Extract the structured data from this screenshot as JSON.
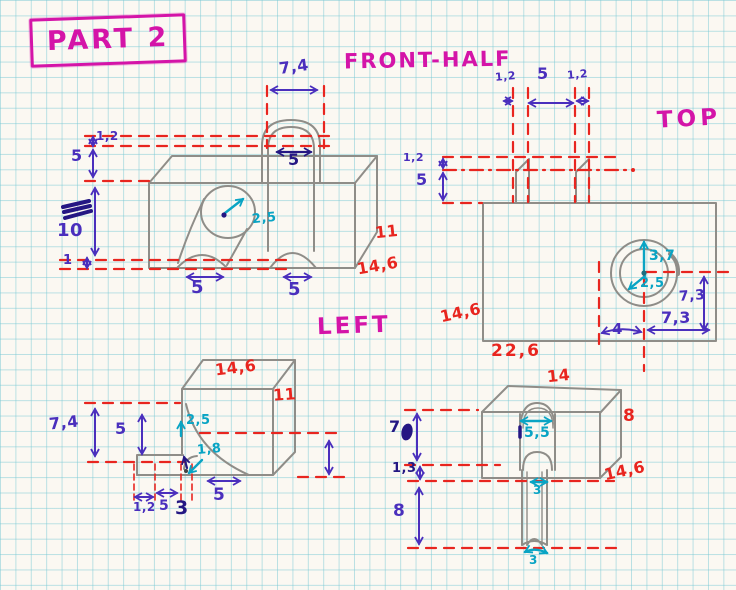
{
  "title": {
    "part_label": "PART 2"
  },
  "colors": {
    "magenta": "#d414a8",
    "purple": "#4a2fbd",
    "teal": "#09a4c4",
    "red": "#e8251f",
    "navy": "#241783",
    "pencil": "#8f8d88"
  },
  "views": {
    "front": {
      "label": "FRONT-HALF",
      "dims": {
        "tab_outer_width": "7,4",
        "slot_width": "5",
        "top_lip": "1,2",
        "upper_height": "5",
        "mid_height": "10",
        "base_lip": "1",
        "bore_radius": "2,5",
        "left_arch_width": "5",
        "right_arch_width": "5",
        "side_depth": "11",
        "overall_width": "14,6"
      }
    },
    "top": {
      "label": "TOP",
      "dims": {
        "tab_wall_left": "1,2",
        "tab_gap": "5",
        "tab_wall_right": "1,2",
        "edge_lip": "1,2",
        "edge_depth": "5",
        "bore_outer_radius": "3,7",
        "bore_inner_radius": "2,5",
        "bore_offset_y": "7,3",
        "bore_offset_x": "7,3",
        "center_offset": "4",
        "overall_depth": "14,6",
        "overall_width": "22,6"
      }
    },
    "left": {
      "label": "LEFT",
      "dims": {
        "overall_width": "14,6",
        "side_height": "11",
        "corner_radius": "2,5",
        "fillet_radius": "1,8",
        "tongue_height": "7,4",
        "tongue_face": "5",
        "tongue_lip": "1,2",
        "tongue_width": "5",
        "step_width": "3",
        "base_width": "5"
      }
    },
    "bottom": {
      "dims": {
        "top_width": "14",
        "side_height": "8",
        "overall_width": "14,6",
        "upper_height": "7",
        "lip_height": "1,3",
        "pin_length": "8",
        "slot_width": "5,5",
        "pin_width_upper": "3",
        "pin_width_lower": "3"
      }
    }
  }
}
